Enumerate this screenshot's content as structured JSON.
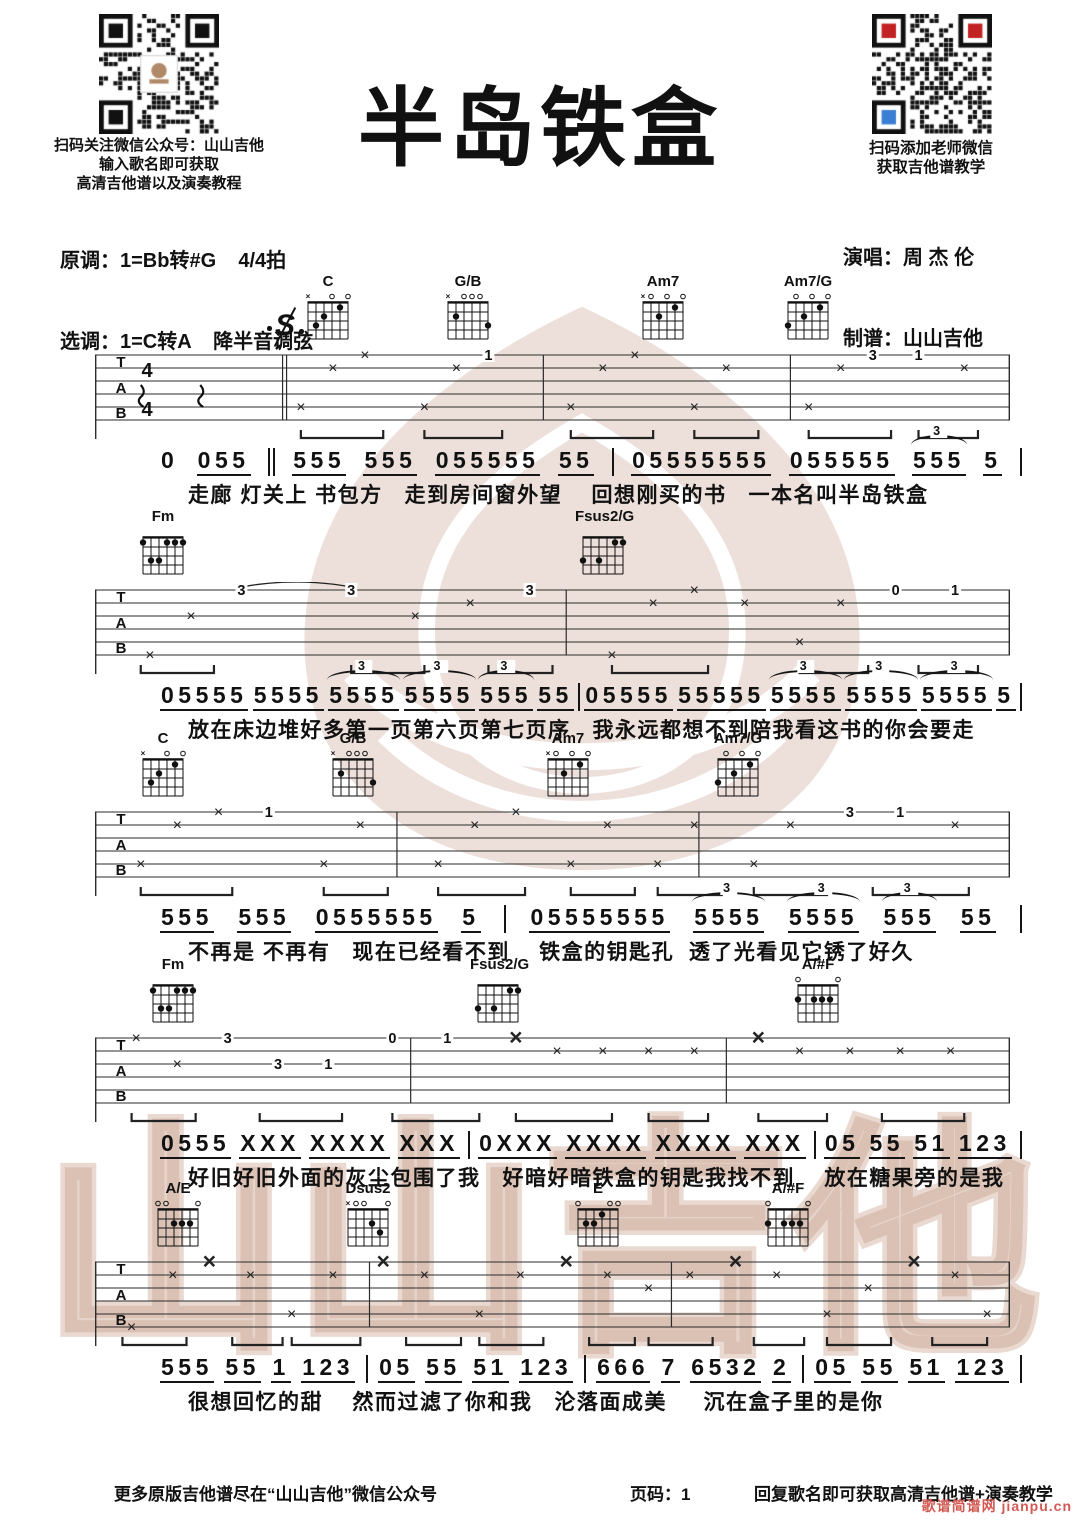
{
  "header": {
    "left_qr_caption": [
      "扫码关注微信公众号：山山吉他",
      "输入歌名即可获取",
      "高清吉他谱以及演奏教程"
    ],
    "key_original": "原调：1=Bb转#G    4/4拍",
    "key_selected": "选调：1=C转A    降半音调弦",
    "title": "半岛铁盒",
    "right_qr_caption": [
      "扫码添加老师微信",
      "获取吉他谱教学"
    ],
    "singer": "演唱：周 杰 伦",
    "arranger": "制谱：山山吉他"
  },
  "notation": {
    "tab_letters": [
      "T",
      "A",
      "B"
    ],
    "segno": "S",
    "time_top": "4",
    "time_bottom": "4"
  },
  "chord_shapes": {
    "C": {
      "markers": "x--o-o",
      "dots": [
        [
          2,
          3
        ],
        [
          3,
          2
        ],
        [
          5,
          1
        ]
      ]
    },
    "G/B": {
      "markers": "x-ooo-",
      "dots": [
        [
          2,
          2
        ],
        [
          6,
          3
        ]
      ]
    },
    "Am7": {
      "markers": "xo-o-o",
      "dots": [
        [
          3,
          2
        ],
        [
          5,
          1
        ]
      ]
    },
    "Am7/G": {
      "markers": "-o-o-o",
      "dots": [
        [
          1,
          3
        ],
        [
          3,
          2
        ],
        [
          5,
          1
        ]
      ]
    },
    "Fm": {
      "markers": "------",
      "dots": [
        [
          1,
          1
        ],
        [
          4,
          1
        ],
        [
          5,
          1
        ],
        [
          6,
          1
        ],
        [
          2,
          3
        ],
        [
          3,
          3
        ]
      ]
    },
    "Fsus2/G": {
      "markers": "------",
      "dots": [
        [
          1,
          3
        ],
        [
          3,
          3
        ],
        [
          5,
          1
        ],
        [
          6,
          1
        ]
      ]
    },
    "A/#F": {
      "markers": "o----o",
      "dots": [
        [
          1,
          2
        ],
        [
          3,
          2
        ],
        [
          4,
          2
        ],
        [
          5,
          2
        ]
      ]
    },
    "A/E": {
      "markers": "oo---o",
      "dots": [
        [
          3,
          2
        ],
        [
          4,
          2
        ],
        [
          5,
          2
        ]
      ]
    },
    "Dsus2": {
      "markers": "xoo--o",
      "dots": [
        [
          4,
          2
        ],
        [
          5,
          3
        ]
      ]
    },
    "E": {
      "markers": "o---oo",
      "dots": [
        [
          2,
          2
        ],
        [
          3,
          2
        ],
        [
          4,
          1
        ]
      ]
    }
  },
  "systems": [
    {
      "top": 283,
      "segno": true,
      "segno_x": 272,
      "time": true,
      "chords": [
        {
          "name": "C",
          "x": 300
        },
        {
          "name": "G/B",
          "x": 440
        },
        {
          "name": "Am7",
          "x": 635
        },
        {
          "name": "Am7/G",
          "x": 780
        }
      ],
      "tab": {
        "barlines": [
          {
            "f": 0.205,
            "double": true
          },
          {
            "f": 0.49
          },
          {
            "f": 0.76
          }
        ],
        "marks": [
          [
            0.05,
            4,
            "r"
          ],
          [
            0.115,
            4,
            "r"
          ],
          [
            0.225,
            5,
            "x"
          ],
          [
            0.26,
            2,
            "x"
          ],
          [
            0.295,
            1,
            "x"
          ],
          [
            0.36,
            5,
            "x"
          ],
          [
            0.395,
            2,
            "x"
          ],
          [
            0.43,
            1,
            "1"
          ],
          [
            0.52,
            5,
            "x"
          ],
          [
            0.555,
            2,
            "x"
          ],
          [
            0.59,
            1,
            "x"
          ],
          [
            0.655,
            5,
            "x"
          ],
          [
            0.69,
            2,
            "x"
          ],
          [
            0.78,
            5,
            "x"
          ],
          [
            0.815,
            2,
            "x"
          ],
          [
            0.85,
            1,
            "3"
          ],
          [
            0.9,
            1,
            "1"
          ],
          [
            0.95,
            2,
            "x"
          ]
        ],
        "beams": [
          [
            0.225,
            0.315
          ],
          [
            0.36,
            0.445
          ],
          [
            0.52,
            0.61
          ],
          [
            0.655,
            0.725
          ],
          [
            0.78,
            0.87
          ],
          [
            0.9,
            0.965
          ]
        ],
        "ties": []
      },
      "melody": [
        "n:0",
        "055",
        "‖",
        "555",
        "555",
        "055555",
        "55",
        "|",
        "05555555",
        "055555",
        "3:555",
        "5",
        "|"
      ],
      "lyrics": "走廊 灯关上 书包方   走到房间窗外望    回想刚买的书   一本名叫半岛铁盒"
    },
    {
      "top": 518,
      "chords": [
        {
          "name": "Fm",
          "x": 135
        },
        {
          "name": "Fsus2/G",
          "x": 575
        }
      ],
      "tab": {
        "barlines": [
          {
            "f": 0.515
          }
        ],
        "marks": [
          [
            0.06,
            6,
            "x"
          ],
          [
            0.105,
            3,
            "x"
          ],
          [
            0.16,
            1,
            "3"
          ],
          [
            0.28,
            1,
            "3"
          ],
          [
            0.35,
            3,
            "x"
          ],
          [
            0.41,
            2,
            "x"
          ],
          [
            0.475,
            1,
            "3"
          ],
          [
            0.565,
            6,
            "x"
          ],
          [
            0.61,
            2,
            "x"
          ],
          [
            0.655,
            1,
            "x"
          ],
          [
            0.71,
            2,
            "x"
          ],
          [
            0.77,
            5,
            "x"
          ],
          [
            0.815,
            2,
            "x"
          ],
          [
            0.875,
            1,
            "0"
          ],
          [
            0.94,
            1,
            "1"
          ]
        ],
        "beams": [
          [
            0.05,
            0.13
          ],
          [
            0.28,
            0.36
          ],
          [
            0.43,
            0.5
          ],
          [
            0.565,
            0.67
          ],
          [
            0.77,
            0.845
          ],
          [
            0.9,
            0.965
          ]
        ],
        "ties": [
          [
            0.16,
            0.28
          ]
        ]
      },
      "melody": [
        "05555",
        "5555",
        "3:5555",
        "3:5555",
        "3:555",
        "55",
        "|",
        "05555",
        "55555",
        "3:5555",
        "3:5555",
        "3:5555",
        "5",
        "|"
      ],
      "lyrics": "放在床边堆好多第一页第六页第七页序   我永远都想不到陪我看这书的你会要走"
    },
    {
      "top": 740,
      "chords": [
        {
          "name": "C",
          "x": 135
        },
        {
          "name": "G/B",
          "x": 325
        },
        {
          "name": "Am7",
          "x": 540
        },
        {
          "name": "Am7/G",
          "x": 710
        }
      ],
      "tab": {
        "barlines": [
          {
            "f": 0.33
          },
          {
            "f": 0.66
          }
        ],
        "marks": [
          [
            0.05,
            5,
            "x"
          ],
          [
            0.09,
            2,
            "x"
          ],
          [
            0.135,
            1,
            "x"
          ],
          [
            0.19,
            1,
            "1"
          ],
          [
            0.25,
            5,
            "x"
          ],
          [
            0.29,
            2,
            "x"
          ],
          [
            0.375,
            5,
            "x"
          ],
          [
            0.415,
            2,
            "x"
          ],
          [
            0.46,
            1,
            "x"
          ],
          [
            0.52,
            5,
            "x"
          ],
          [
            0.56,
            2,
            "x"
          ],
          [
            0.615,
            5,
            "x"
          ],
          [
            0.655,
            2,
            "x"
          ],
          [
            0.72,
            5,
            "x"
          ],
          [
            0.76,
            2,
            "x"
          ],
          [
            0.825,
            1,
            "3"
          ],
          [
            0.88,
            1,
            "1"
          ],
          [
            0.94,
            2,
            "x"
          ]
        ],
        "beams": [
          [
            0.05,
            0.15
          ],
          [
            0.25,
            0.32
          ],
          [
            0.375,
            0.47
          ],
          [
            0.52,
            0.59
          ],
          [
            0.615,
            0.685
          ],
          [
            0.72,
            0.8
          ],
          [
            0.85,
            0.955
          ]
        ],
        "ties": []
      },
      "melody": [
        "555",
        "555",
        "0555555",
        "5",
        "|",
        "05555555",
        "3:5555",
        "3:5555",
        "3:555",
        "55",
        "|"
      ],
      "lyrics": "不再是 不再有   现在已经看不到    铁盒的钥匙孔  透了光看见它锈了好久"
    },
    {
      "top": 966,
      "chords": [
        {
          "name": "Fm",
          "x": 145
        },
        {
          "name": "Fsus2/G",
          "x": 470
        },
        {
          "name": "A/#F",
          "x": 790
        }
      ],
      "tab": {
        "barlines": [
          {
            "f": 0.345
          },
          {
            "f": 0.69
          }
        ],
        "marks": [
          [
            0.045,
            1,
            "x"
          ],
          [
            0.09,
            3,
            "x"
          ],
          [
            0.145,
            1,
            "3"
          ],
          [
            0.2,
            3,
            "3"
          ],
          [
            0.255,
            3,
            "1"
          ],
          [
            0.325,
            1,
            "0"
          ],
          [
            0.385,
            1,
            "1"
          ],
          [
            0.46,
            1,
            "X"
          ],
          [
            0.505,
            2,
            "x"
          ],
          [
            0.555,
            2,
            "x"
          ],
          [
            0.605,
            2,
            "x"
          ],
          [
            0.655,
            2,
            "x"
          ],
          [
            0.725,
            1,
            "X"
          ],
          [
            0.77,
            2,
            "x"
          ],
          [
            0.825,
            2,
            "x"
          ],
          [
            0.88,
            2,
            "x"
          ],
          [
            0.935,
            2,
            "x"
          ]
        ],
        "beams": [
          [
            0.04,
            0.11
          ],
          [
            0.18,
            0.27
          ],
          [
            0.325,
            0.42
          ],
          [
            0.46,
            0.565
          ],
          [
            0.605,
            0.67
          ],
          [
            0.725,
            0.8
          ],
          [
            0.86,
            0.95
          ]
        ],
        "ties": []
      },
      "melody": [
        "0555",
        "XXX",
        "XXXX",
        "XXX",
        "|",
        "0XXX",
        "XXXX",
        "XXXX",
        "XXX",
        "|",
        "05",
        "55",
        "51",
        "123",
        "|"
      ],
      "lyrics": "好旧好旧外面的灰尘包围了我   好暗好暗铁盒的钥匙我找不到    放在糖果旁的是我"
    },
    {
      "top": 1190,
      "chords": [
        {
          "name": "A/E",
          "x": 150
        },
        {
          "name": "Dsus2",
          "x": 340
        },
        {
          "name": "E",
          "x": 570
        },
        {
          "name": "A/#F",
          "x": 760
        }
      ],
      "tab": {
        "barlines": [
          {
            "f": 0.3
          },
          {
            "f": 0.63
          }
        ],
        "marks": [
          [
            0.04,
            6,
            "x"
          ],
          [
            0.085,
            2,
            "x"
          ],
          [
            0.125,
            1,
            "X"
          ],
          [
            0.17,
            2,
            "x"
          ],
          [
            0.215,
            5,
            "x"
          ],
          [
            0.26,
            2,
            "x"
          ],
          [
            0.315,
            1,
            "X"
          ],
          [
            0.36,
            2,
            "x"
          ],
          [
            0.42,
            5,
            "x"
          ],
          [
            0.465,
            2,
            "x"
          ],
          [
            0.515,
            1,
            "X"
          ],
          [
            0.56,
            2,
            "x"
          ],
          [
            0.605,
            3,
            "x"
          ],
          [
            0.65,
            2,
            "x"
          ],
          [
            0.7,
            1,
            "X"
          ],
          [
            0.745,
            2,
            "x"
          ],
          [
            0.8,
            5,
            "x"
          ],
          [
            0.845,
            3,
            "x"
          ],
          [
            0.895,
            1,
            "X"
          ],
          [
            0.94,
            2,
            "x"
          ],
          [
            0.975,
            5,
            "x"
          ]
        ],
        "beams": [
          [
            0.03,
            0.1
          ],
          [
            0.15,
            0.205
          ],
          [
            0.215,
            0.29
          ],
          [
            0.34,
            0.4
          ],
          [
            0.42,
            0.49
          ],
          [
            0.54,
            0.59
          ],
          [
            0.605,
            0.675
          ],
          [
            0.72,
            0.775
          ],
          [
            0.8,
            0.87
          ],
          [
            0.915,
            0.975
          ]
        ],
        "ties": []
      },
      "melody": [
        "555",
        "55",
        "1",
        "123",
        "|",
        "05",
        "55",
        "51",
        "123",
        "|",
        "666",
        "7",
        "6532",
        "2",
        "|",
        "05",
        "55",
        "51",
        "123",
        "|"
      ],
      "lyrics": "很想回忆的甜    然而过滤了你和我   沦落面成美     沉在盒子里的是你"
    }
  ],
  "footer": {
    "left": "更多原版吉他谱尽在“山山吉他”微信公众号",
    "page": "页码：1",
    "right": "回复歌名即可获取高清吉他谱+演奏教学",
    "corner": "歌谱简谱网 jianpu.cn"
  },
  "watermark_text": "山山吉他",
  "colors": {
    "watermark": "#c9a495",
    "corner_red": "#d25a54",
    "qr_red": "#c32222",
    "qr_blue": "#3b7fd4"
  }
}
